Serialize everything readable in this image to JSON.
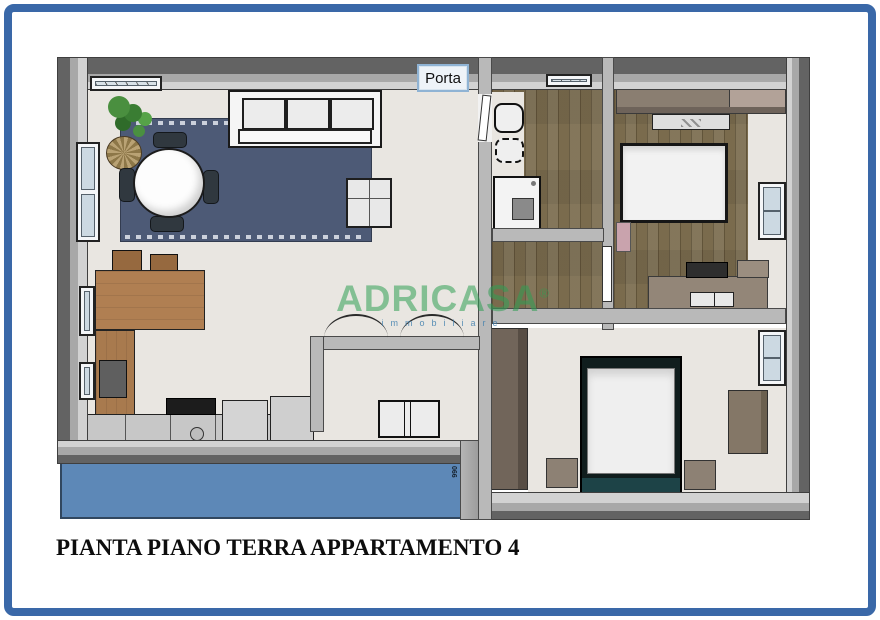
{
  "frame": {
    "border_color": "#3a68a8"
  },
  "caption": {
    "text": "PIANTA PIANO TERRA APPARTAMENTO 4"
  },
  "door_tooltip": {
    "label": "Porta"
  },
  "watermark": {
    "brand": "ADRICASA",
    "registered_mark": "®",
    "subtitle": "immobiliare"
  },
  "terrace": {
    "dimension_label": "066"
  },
  "palette": {
    "wall_gray": "#9a9a9a",
    "wood_light": "#a6936b",
    "wood_dark": "#7a6b4d",
    "rug_blue": "#4d5a76",
    "terrace_blue": "#5d88b7",
    "kitchen_wood": "#b07f52",
    "furniture_taupe": "#8d8276",
    "accent_pink": "#c9a3ad",
    "watermark_green": "#2f9e53"
  }
}
